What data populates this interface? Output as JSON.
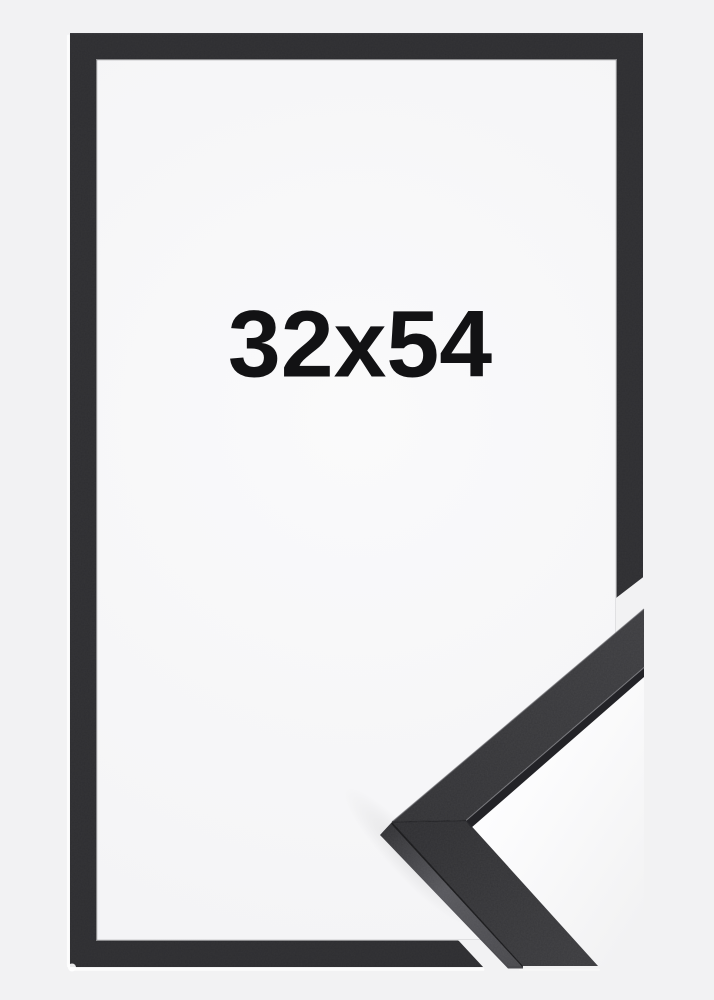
{
  "product_image": {
    "size_label": "32x54",
    "colors": {
      "background": "#f2f2f3",
      "frame": "#2e2e31",
      "frame_interior_light": "#f9f9fa",
      "corner_top_face": "#37373a",
      "corner_side_face": "#55555a",
      "cutout_highlight": "#ffffff",
      "label_text": "#121214"
    }
  }
}
